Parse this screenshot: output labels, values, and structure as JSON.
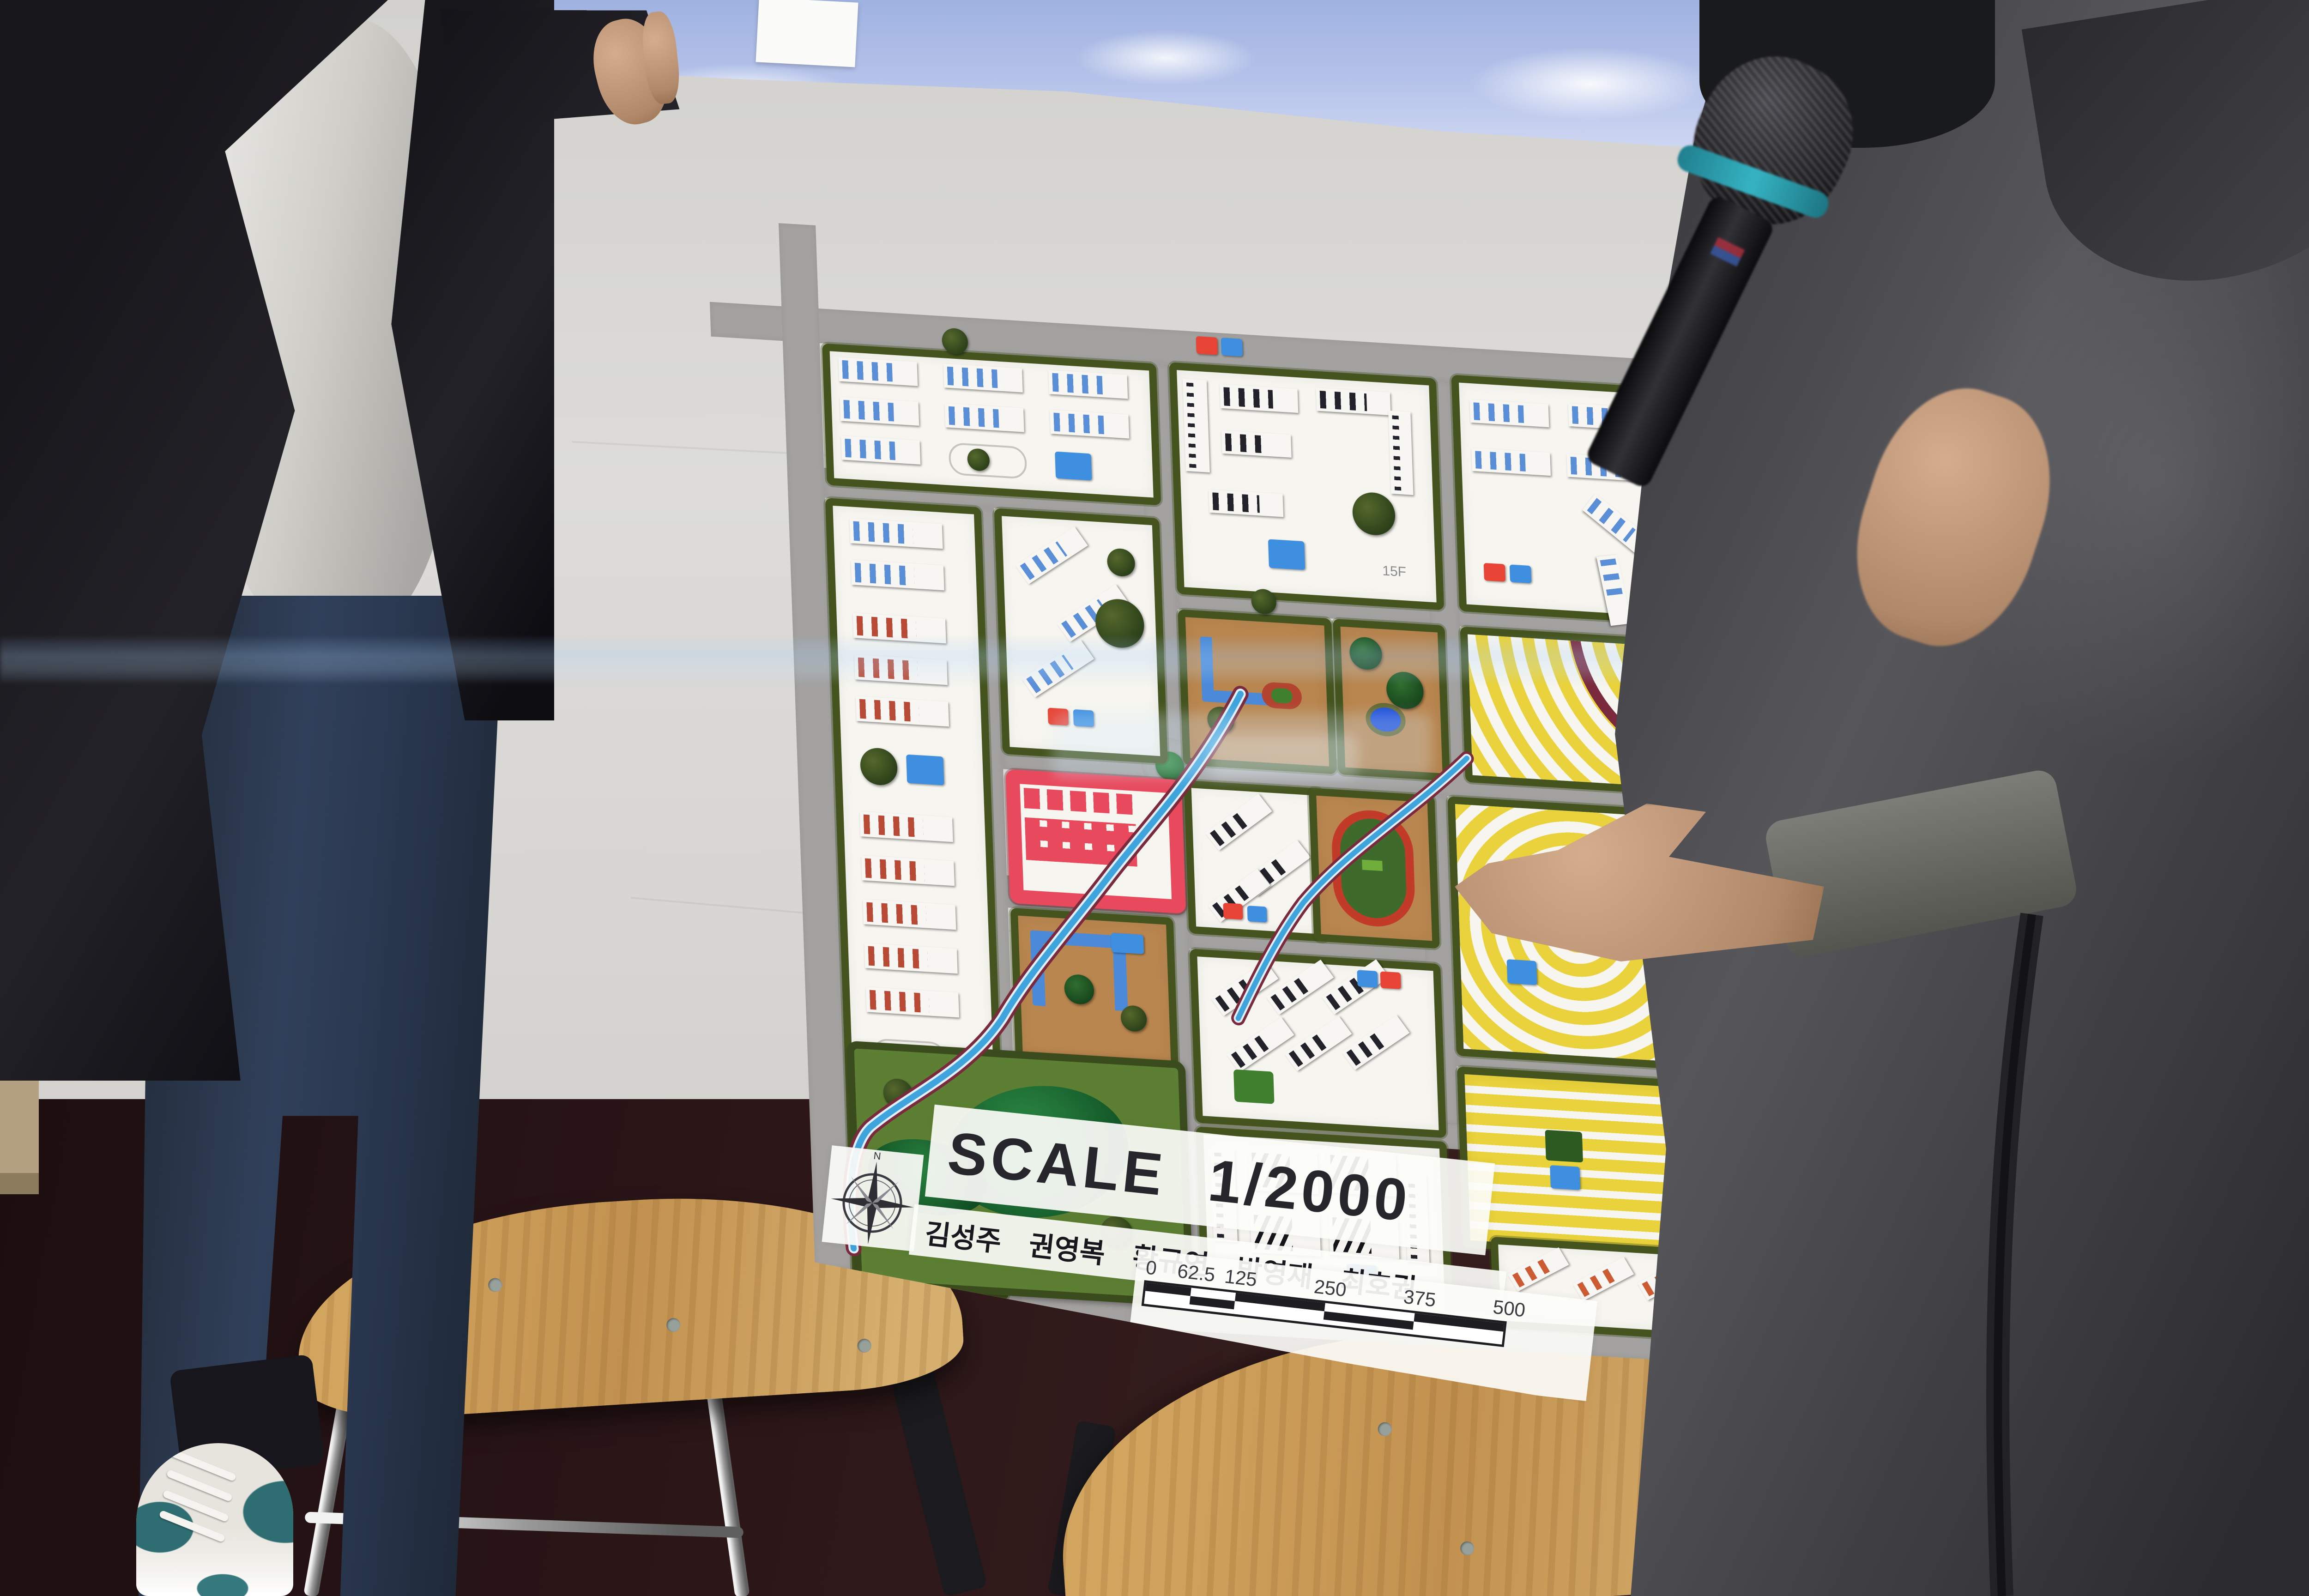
{
  "board": {
    "title": "SCALE 1/2000",
    "authors": "김성주 권영복 황규연 박영재 최호권",
    "compass_letter": "N",
    "floor_label_15f": "15F",
    "floor_label_10f": "10F",
    "scale_bar": {
      "ticks": [
        "0",
        "62.5",
        "125",
        "250",
        "375",
        "500"
      ],
      "unit": "Meter"
    }
  },
  "map_legend": {
    "colors": {
      "road": "#a3a2a0",
      "hedge": "#45541f",
      "ground_white": "#f6f5ef",
      "river_blue": "#3da5e0",
      "stream_bank_maroon": "#7a2a3c",
      "residential_yellow": "#e9d23b",
      "commercial_red": "#e8495c",
      "public_building_blue": "#4a8ad8",
      "schoolyard_brown": "#b9864f",
      "park_green": "#5d7f33",
      "hill_dark_green": "#1e6e35",
      "running_track_red": "#c23b28",
      "roof_fin_blue": "#5a8fd8",
      "roof_fin_red": "#b84a35",
      "roof_fin_black": "#22222a",
      "roof_fin_orange": "#cc5a33"
    }
  },
  "scene": {
    "people": [
      "board-holder-left",
      "presenter-with-microphone-right"
    ],
    "furniture": [
      "wooden-stool-left",
      "wooden-stool-right"
    ],
    "microphone_band_color": "#2a97a6",
    "shoe_accent_color": "#2e6d72"
  }
}
